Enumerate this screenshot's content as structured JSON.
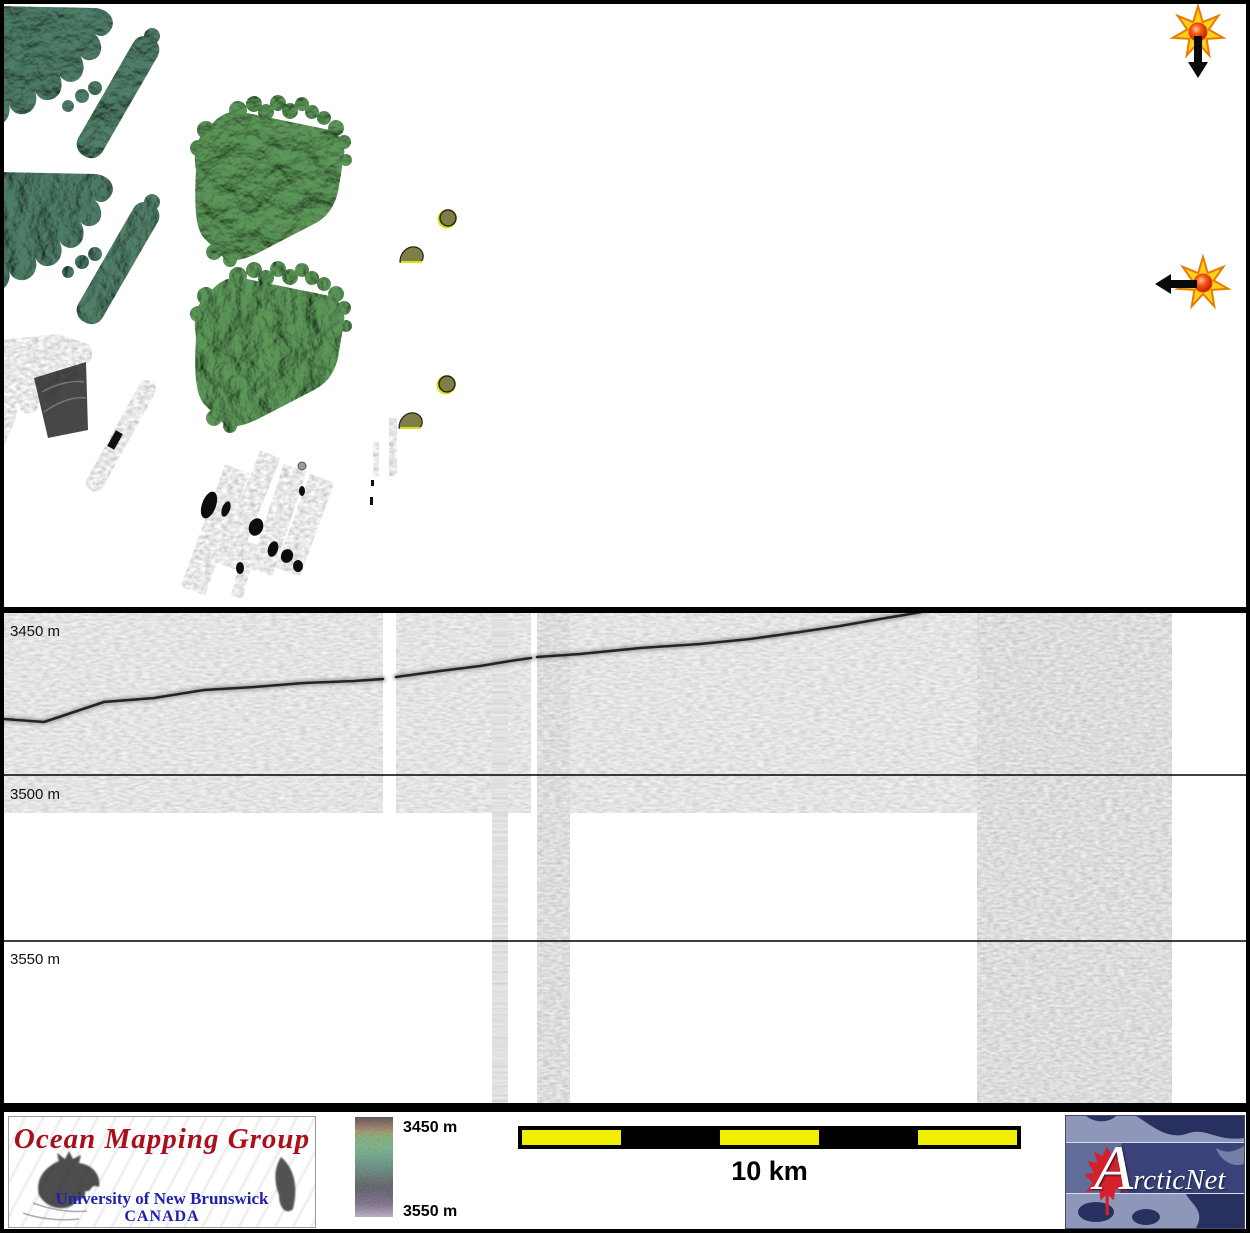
{
  "figure": {
    "description": "Ocean mapping survey figure: shaded bathymetry map (top), sub-bottom profiler echogram (middle), legend footer (bottom)"
  },
  "map": {
    "sun_indicators": [
      {
        "name": "sun-arrow-down",
        "arrow": "down"
      },
      {
        "name": "sun-arrow-left",
        "arrow": "left"
      }
    ],
    "colors": {
      "coast_green": "#4e7e68",
      "swath_green": "#5c9759",
      "survey_dot_olive": "#7e7e48"
    }
  },
  "echogram": {
    "depth_labels": [
      {
        "text": "3450 m"
      },
      {
        "text": "3500 m"
      },
      {
        "text": "3550 m"
      }
    ]
  },
  "chart_data": {
    "type": "heatmap",
    "title": "",
    "ylabel": "depth",
    "yticks": [
      "3450 m",
      "3500 m",
      "3550 m"
    ],
    "ylim": [
      3450,
      3600
    ],
    "grid": "horizontal depth lines every 50 m",
    "series": [
      {
        "name": "seafloor reflector depth (m), sampled left to right",
        "values": [
          3483,
          3482,
          3478,
          3474,
          3472,
          3470,
          3468,
          3466,
          3464,
          3462,
          3459,
          3456,
          3453,
          3450
        ]
      }
    ]
  },
  "legend": {
    "colorbar_top_label": "3450 m",
    "colorbar_bottom_label": "3550 m"
  },
  "scalebar": {
    "label": "10 km",
    "segments": 5,
    "yellow": "#f2ee00"
  },
  "omg_logo": {
    "title": "Ocean Mapping Group",
    "university": "University of New Brunswick",
    "country": "CANADA",
    "title_color": "#a8101c",
    "text_color": "#2121ad"
  },
  "arcticnet_logo": {
    "label": "ArcticNet",
    "navy": "#27305e",
    "leaf_red": "#d5202c"
  }
}
